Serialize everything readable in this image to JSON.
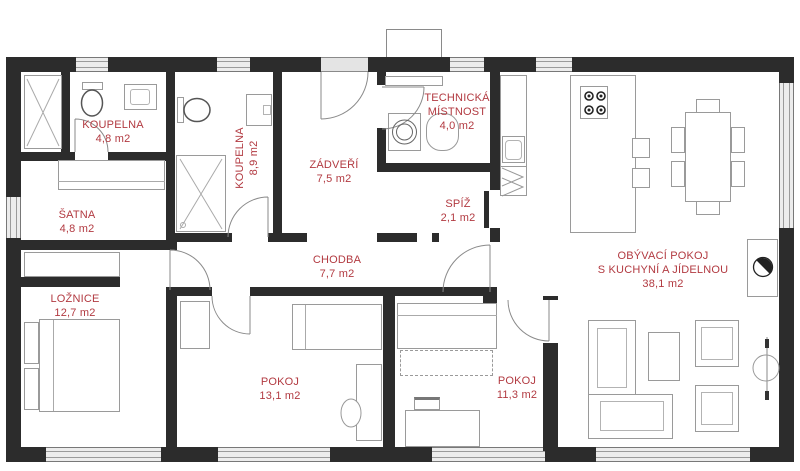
{
  "colors": {
    "accent_label": "#b23a41",
    "wall": "#2c2c2c",
    "window_fill": "#ececec"
  },
  "rooms": [
    {
      "id": "koupelna-small",
      "line1": "KOUPELNA",
      "area": "4,8 m2"
    },
    {
      "id": "koupelna-large",
      "line1": "KOUPELNA",
      "area": "8,9 m2"
    },
    {
      "id": "zadveri",
      "line1": "ZÁDVEŘÍ",
      "area": "7,5 m2"
    },
    {
      "id": "technicka-mistnost",
      "line1": "TECHNICKÁ",
      "line2": "MÍSTNOST",
      "area": "4,0 m2"
    },
    {
      "id": "spiz",
      "line1": "SPÍŽ",
      "area": "2,1 m2"
    },
    {
      "id": "satna",
      "line1": "ŠATNA",
      "area": "4,8 m2"
    },
    {
      "id": "chodba",
      "line1": "CHODBA",
      "area": "7,7 m2"
    },
    {
      "id": "loznice",
      "line1": "LOŽNICE",
      "area": "12,7 m2"
    },
    {
      "id": "pokoj-1",
      "line1": "POKOJ",
      "area": "13,1 m2"
    },
    {
      "id": "pokoj-2",
      "line1": "POKOJ",
      "area": "11,3 m2"
    },
    {
      "id": "obyvaci-pokoj",
      "line1": "OBÝVACÍ POKOJ",
      "line2": "S KUCHYNÍ A JÍDELNOU",
      "area": "38,1 m2"
    }
  ],
  "icons": [
    "shower-icon",
    "toilet-icon",
    "sink-icon",
    "washing-machine-icon",
    "water-heater-icon",
    "stove-icon",
    "kitchen-sink-icon",
    "dining-table-icon",
    "chair-icon",
    "fireplace-icon",
    "bed-icon",
    "sofa-icon",
    "armchair-icon",
    "desk-icon",
    "wardrobe-icon",
    "door-arc-icon",
    "window-icon",
    "chimney-icon"
  ]
}
